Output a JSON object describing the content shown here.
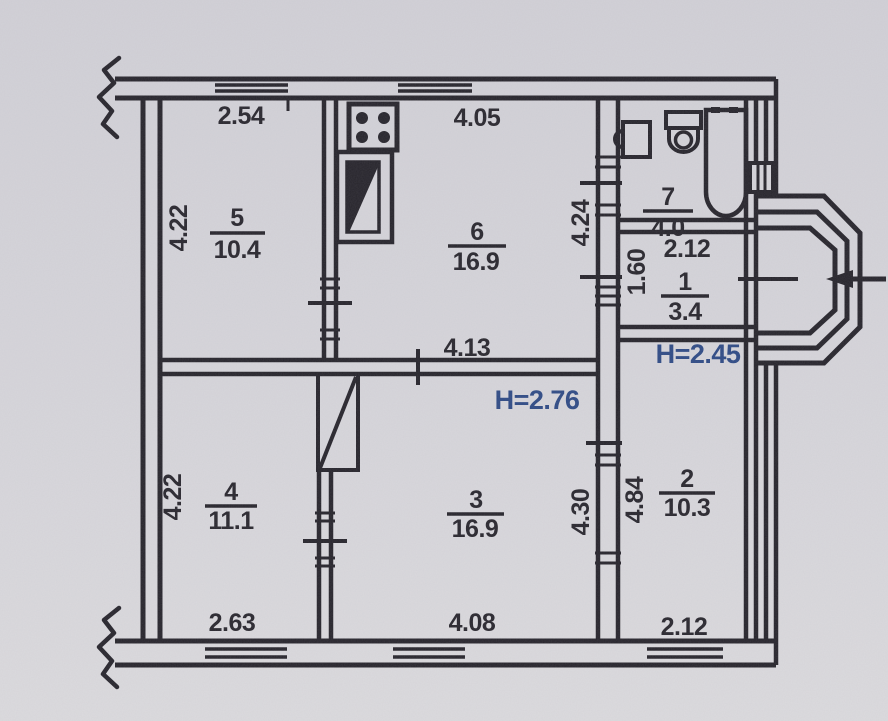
{
  "plan": {
    "heights": {
      "main_rooms": "H=2.76",
      "annex": "H=2.45"
    },
    "rooms": {
      "r1": {
        "number": "1",
        "area": "3.4"
      },
      "r2": {
        "number": "2",
        "area": "10.3"
      },
      "r3": {
        "number": "3",
        "area": "16.9"
      },
      "r4": {
        "number": "4",
        "area": "11.1"
      },
      "r5": {
        "number": "5",
        "area": "10.4"
      },
      "r6": {
        "number": "6",
        "area": "16.9"
      },
      "r7": {
        "number": "7",
        "area": "4.0"
      }
    },
    "dimensions": {
      "room5_width": "2.54",
      "room6_width": "4.05",
      "room5_depth": "4.22",
      "room6_depth": "4.24",
      "room3_width_top": "4.13",
      "room1_width": "2.12",
      "room1_depth": "1.60",
      "room4_depth": "4.22",
      "room3_depth": "4.30",
      "room2_depth": "4.84",
      "room4_width": "2.63",
      "room3_width_bottom": "4.08",
      "room2_width": "2.12"
    },
    "icons": {
      "stove": "gas-stove-4-burner",
      "vent_shaft": "vent-shaft",
      "closet": "built-in-closet",
      "washbasin": "washbasin",
      "toilet": "toilet",
      "bathtub": "bathtub",
      "entrance": "entrance-arrow",
      "bay": "bay-window",
      "break_marks": "wall-break-squiggle"
    },
    "colors": {
      "ink": "#26242b",
      "blue_ink": "#2e4a85",
      "paper": "#d6d5da"
    }
  }
}
